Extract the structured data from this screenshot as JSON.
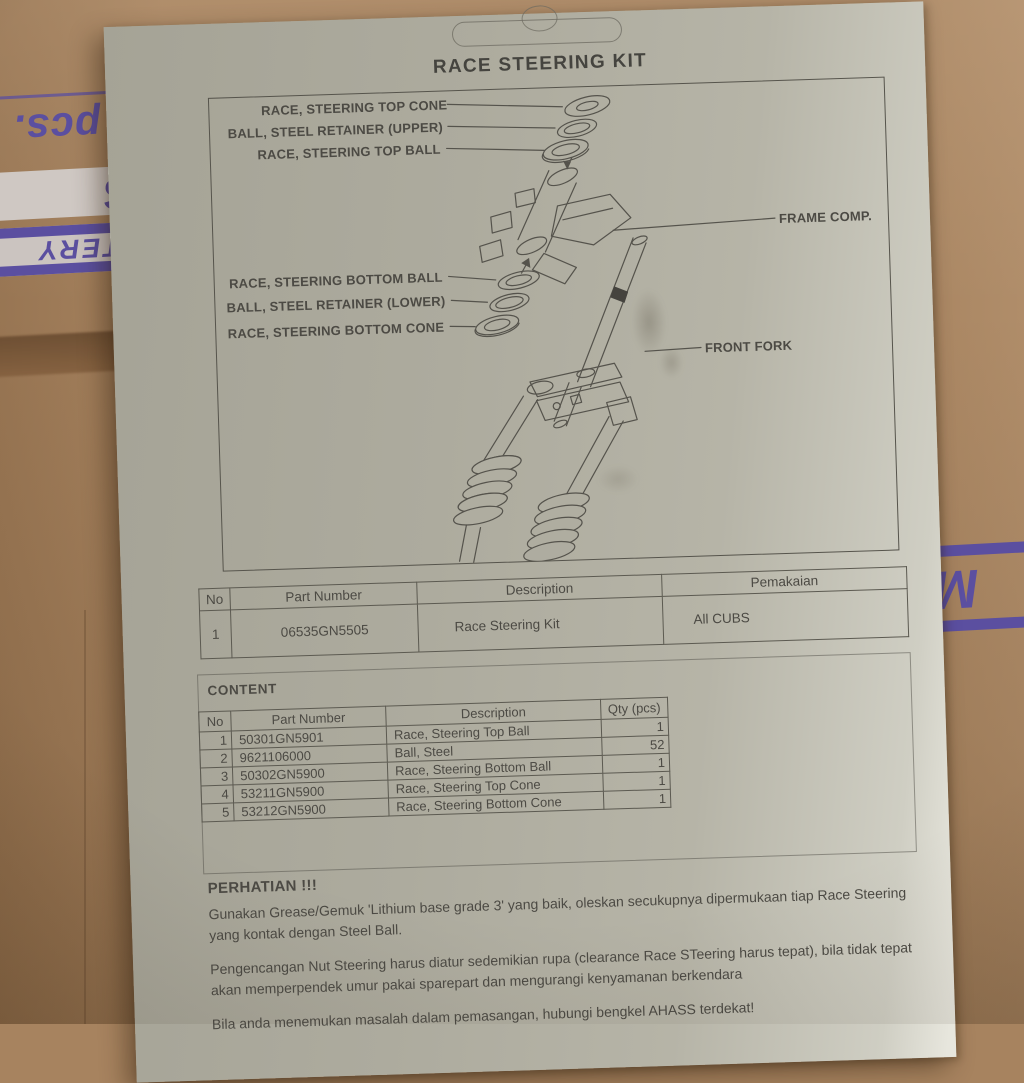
{
  "cardboard": {
    "base_color": "#a7835f",
    "print_color": "#5b4fa0",
    "stripe_bg_color": "#cfc8c3",
    "fragments": {
      "pcs": "pcs.",
      "model": "Z5S",
      "battery": "TTERY",
      "right_letter": "M"
    }
  },
  "sheet": {
    "title": "RACE STEERING KIT",
    "paper_color": "#b2b0a3",
    "ink_color": "#4c4a44",
    "diagram": {
      "labels": {
        "top_cone": "RACE, STEERING TOP CONE",
        "retainer_upper": "BALL, STEEL RETAINER (UPPER)",
        "top_ball": "RACE, STEERING TOP BALL",
        "bottom_ball": "RACE, STEERING BOTTOM BALL",
        "retainer_lower": "BALL, STEEL RETAINER (LOWER)",
        "bottom_cone": "RACE, STEERING BOTTOM CONE",
        "frame_comp": "FRAME COMP.",
        "front_fork": "FRONT FORK"
      }
    },
    "kit_table": {
      "headers": [
        "No",
        "Part Number",
        "Description",
        "Pemakaian"
      ],
      "row": {
        "no": "1",
        "part_number": "06535GN5505",
        "description": "Race Steering Kit",
        "pemakaian": "All CUBS"
      }
    },
    "content": {
      "heading": "CONTENT",
      "table": {
        "headers": [
          "No",
          "Part Number",
          "Description",
          "Qty (pcs)"
        ],
        "rows": [
          {
            "no": "1",
            "part_number": "50301GN5901",
            "description": "Race, Steering Top Ball",
            "qty": "1"
          },
          {
            "no": "2",
            "part_number": "9621106000",
            "description": "Ball, Steel",
            "qty": "52"
          },
          {
            "no": "3",
            "part_number": "50302GN5900",
            "description": "Race, Steering Bottom Ball",
            "qty": "1"
          },
          {
            "no": "4",
            "part_number": "53211GN5900",
            "description": "Race, Steering Top Cone",
            "qty": "1"
          },
          {
            "no": "5",
            "part_number": "53212GN5900",
            "description": "Race, Steering Bottom Cone",
            "qty": "1"
          }
        ]
      }
    },
    "warning": {
      "heading": "PERHATIAN !!!",
      "paragraphs": [
        "Gunakan Grease/Gemuk 'Lithium base grade 3' yang baik, oleskan secukupnya dipermukaan tiap Race Steering yang kontak dengan Steel Ball.",
        "Pengencangan Nut Steering harus diatur sedemikian rupa (clearance Race STeering harus tepat), bila tidak tepat akan memperpendek umur pakai sparepart dan mengurangi kenyamanan berkendara",
        "Bila anda menemukan masalah dalam pemasangan, hubungi bengkel AHASS terdekat!"
      ]
    }
  }
}
